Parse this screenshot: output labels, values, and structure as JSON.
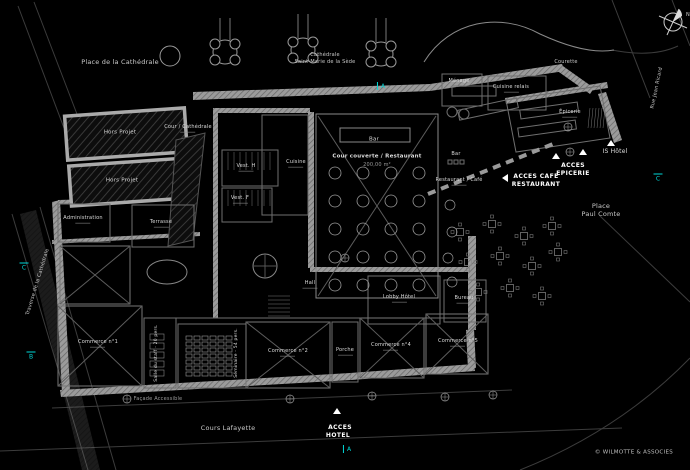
{
  "colors": {
    "accent_cyan": "#00d9d9",
    "linework": "#9a9a9a",
    "background": "#000000"
  },
  "streets": {
    "place_cathedrale": "Place de la Cathédrale",
    "cathedrale_l1": "Cathédrale",
    "cathedrale_l2": "Saint-Marie de la Sède",
    "courette": "Courette",
    "traverse": "Traverse de la Cathédrale",
    "rue_jean_ricard": "Rue Jean Ricard",
    "cours_lafayette": "Cours Lafayette",
    "place_paul_comte_l1": "Place",
    "place_paul_comte_l2": "Paul Comte",
    "facade_accessible": "Façade Accessible"
  },
  "rooms": [
    {
      "label": "Hors Projet"
    },
    {
      "label": "Hors Projet"
    },
    {
      "label": "Cour / Cathédrale"
    },
    {
      "label": "Administration"
    },
    {
      "label": "Terrasse"
    },
    {
      "label": "Vest. H"
    },
    {
      "label": "Vest. F"
    },
    {
      "label": "Cuisine"
    },
    {
      "label": "Bar"
    },
    {
      "label": "Cour couverte / Restaurant",
      "sub": "200,00 m²"
    },
    {
      "label": "Ménage"
    },
    {
      "label": "Cuisine relais"
    },
    {
      "label": "Épicerie"
    },
    {
      "label": "Bar"
    },
    {
      "label": "Restaurant / Café"
    },
    {
      "label": "Lobby Hôtel"
    },
    {
      "label": "Bureau"
    },
    {
      "label": "Hall"
    },
    {
      "label": "Commerce n°1"
    },
    {
      "label": "Commerce n°2"
    },
    {
      "label": "Porche"
    },
    {
      "label": "Commerce n°4"
    },
    {
      "label": "Commerce n°5"
    },
    {
      "label": "Séminaire - 54 pers."
    },
    {
      "label": "Salle du staff - 20 pers."
    }
  ],
  "access": {
    "cafe_l1": "ACCES CAFE",
    "cafe_l2": "RESTAURANT",
    "epicerie_l1": "ACCES",
    "epicerie_l2": "EPICERIE",
    "hotel_l1": "ACCES",
    "hotel_l2": "HOTEL",
    "is_hotel": "IS  Hôtel"
  },
  "section_markers": {
    "a_top": "A",
    "a_bottom": "A",
    "b_left": "B",
    "c_left": "C",
    "c_right": "C"
  },
  "compass": {
    "north": "N"
  },
  "credit": "© WILMOTTE & ASSOCIES"
}
